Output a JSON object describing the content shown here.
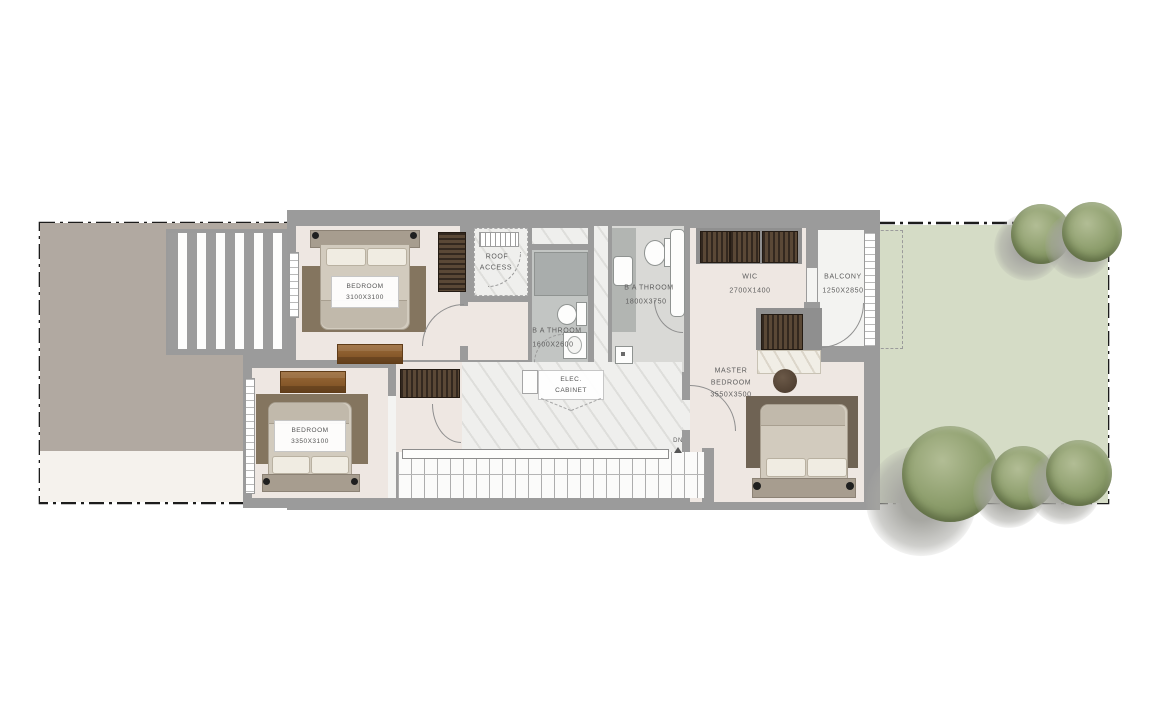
{
  "plan": {
    "type": "residential floor plan",
    "rooms": {
      "bedroom1": {
        "name": "BEDROOM",
        "dims": "3100X3100"
      },
      "bedroom2": {
        "name": "BEDROOM",
        "dims": "3350X3100"
      },
      "master_bedroom": {
        "name_line1": "MASTER",
        "name_line2": "BEDROOM",
        "dims": "3550X3500"
      },
      "bathroom_small": {
        "name": "B A THROOM",
        "dims": "1600X2600"
      },
      "bathroom_master": {
        "name": "B A THROOM",
        "dims": "1800X3750"
      },
      "wic": {
        "name": "WIC",
        "dims": "2700X1400"
      },
      "balcony": {
        "name": "BALCONY",
        "dims": "1250X2850"
      },
      "roof_access": {
        "line1": "ROOF",
        "line2": "ACCESS"
      },
      "elec_cabinet": {
        "line1": "ELEC.",
        "line2": "CABINET"
      },
      "stairs": {
        "label": "DN"
      }
    },
    "colors": {
      "wall_gray": "#9b9b9b",
      "bedroom_floor": "#eee7e2",
      "corridor_marble": "#efefed",
      "bathroom_floor": "#c2c5c3",
      "shower_gray": "#a9adac",
      "patio_taupe": "#b1a9a1",
      "garden_green": "#d5dcc6",
      "tree_green": "#8b9c6a",
      "wood_brown": "#8a5c33",
      "boundary_black": "#1c1c1c"
    }
  }
}
